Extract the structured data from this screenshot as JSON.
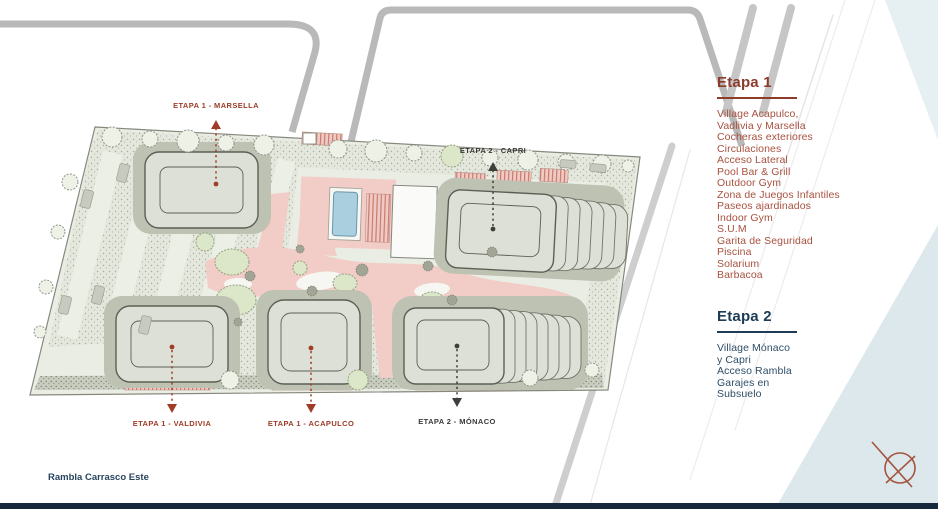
{
  "title": "Master plan - Etapas del proyecto",
  "street_label": "Rambla Carrasco Este",
  "legend": {
    "etapa1": {
      "title": "Etapa 1",
      "color": "#8E3B2C",
      "items_color": "#A8513F",
      "items": [
        "Village Acapulco,",
        "Vadlivia y Marsella",
        "Cocheras exteriores",
        "Circulaciones",
        "Acceso Lateral",
        "Pool Bar & Grill",
        "Outdoor Gym",
        "Zona de Juegos Infantiles",
        "Paseos ajardinados",
        "Indoor Gym",
        "S.U.M",
        "Garita de Seguridad",
        "Piscina",
        "Solarium",
        "Barbacoa"
      ]
    },
    "etapa2": {
      "title": "Etapa 2",
      "color": "#1E3C55",
      "items_color": "#2E4E68",
      "items": [
        "Village Mónaco",
        "y Capri",
        "Acceso Rambla",
        "Garajes en",
        "Subsuelo"
      ]
    }
  },
  "plan": {
    "labels": [
      {
        "id": "marsella",
        "text": "ETAPA 1 - MARSELLA",
        "color": "#9E3B28"
      },
      {
        "id": "capri",
        "text": "ETAPA 2 - CAPRI",
        "color": "#3A3A38"
      },
      {
        "id": "valdivia",
        "text": "ETAPA 1 - VALDIVIA",
        "color": "#9E3B28"
      },
      {
        "id": "acapulco",
        "text": "ETAPA 1 - ACAPULCO",
        "color": "#9E3B28"
      },
      {
        "id": "monaco",
        "text": "ETAPA 2 - MÓNACO",
        "color": "#3A3A38"
      }
    ],
    "colors": {
      "site_fill": "#EAEDE4",
      "building_fill": "#DDE0D6",
      "path_pink": "#F2CCC6",
      "pool_blue": "#AACFDF",
      "water_wedge_blue": "#DCE8EC",
      "bottom_bar_navy": "#16293C",
      "compass_red": "#A5553F"
    }
  }
}
